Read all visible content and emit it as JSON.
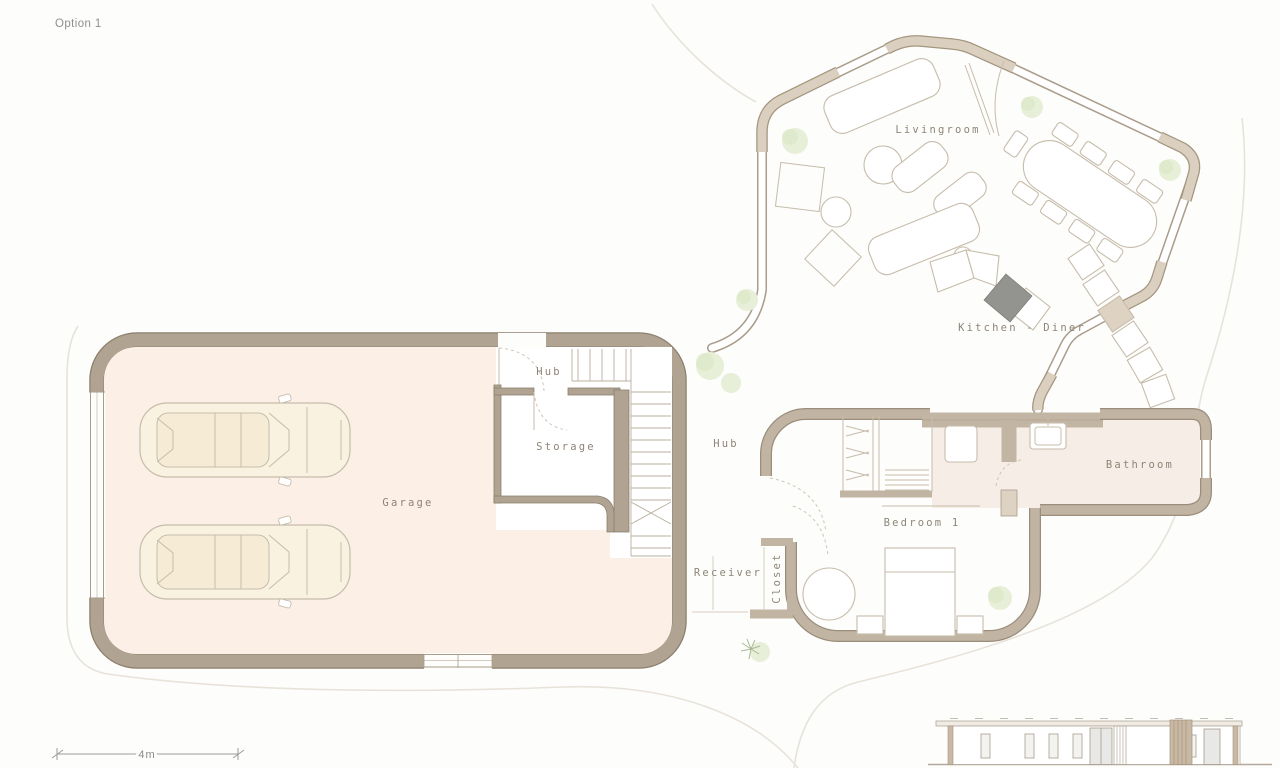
{
  "sheet": {
    "title": "Option 1"
  },
  "labels": {
    "livingroom": "Livingroom",
    "kitchen_diner": "Kitchen - Diner",
    "hub_entry": "Hub",
    "hub_corridor": "Hub",
    "storage": "Storage",
    "garage": "Garage",
    "bathroom": "Bathroom",
    "bedroom_1": "Bedroom 1",
    "receiver": "Receiver",
    "closet": "Closet"
  },
  "scale_bar": {
    "label": "4m"
  },
  "colors": {
    "wall_dark": "#b1a391",
    "wall_light": "#dbd0c0",
    "wing_wall": "#c2b4a2",
    "garage_floor": "#fcefe6",
    "bathroom_floor": "#f6ede6",
    "furniture_line": "#c6bcab",
    "label_text": "#8e8576",
    "tree": "#e7efd8",
    "cooktop": "#93938f"
  },
  "drawing": {
    "type": "floor-plan",
    "views": [
      "plan",
      "front-elevation"
    ],
    "symbols": [
      "car",
      "car",
      "bed",
      "dining-table",
      "sofa",
      "stairs",
      "trees",
      "shower",
      "wardrobe",
      "sink",
      "toilet",
      "cooktop"
    ]
  }
}
